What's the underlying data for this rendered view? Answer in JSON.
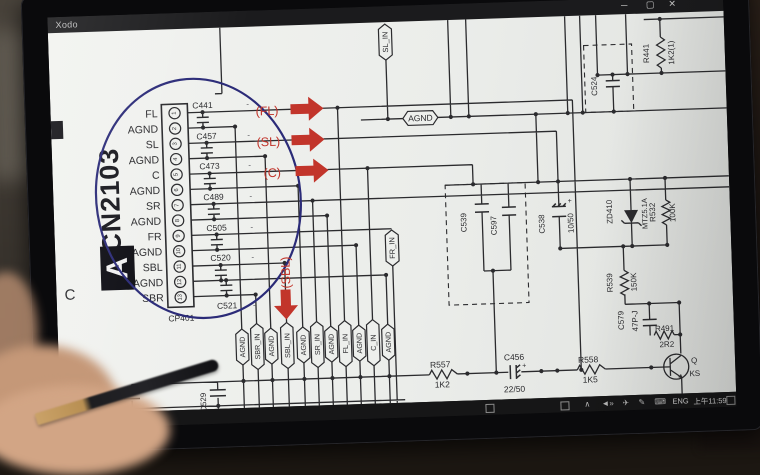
{
  "window": {
    "title": "Xodo",
    "controls": {
      "minimize": "─",
      "maximize": "▢",
      "close": "✕"
    }
  },
  "taskbar": {
    "lang": "ENG",
    "time": "上午11:59"
  },
  "schematic": {
    "grid_letter": "C",
    "dash": "-",
    "connector": {
      "designator_large": "CN2103",
      "marker": "A",
      "footprint": "CP401",
      "pins": [
        {
          "num": "1",
          "name": "FL"
        },
        {
          "num": "2",
          "name": "AGND"
        },
        {
          "num": "3",
          "name": "SL"
        },
        {
          "num": "4",
          "name": "AGND"
        },
        {
          "num": "5",
          "name": "C"
        },
        {
          "num": "6",
          "name": "AGND"
        },
        {
          "num": "7",
          "name": "SR"
        },
        {
          "num": "8",
          "name": "AGND"
        },
        {
          "num": "9",
          "name": "FR"
        },
        {
          "num": "10",
          "name": "AGND"
        },
        {
          "num": "11",
          "name": "SBL"
        },
        {
          "num": "12",
          "name": "AGND"
        },
        {
          "num": "13",
          "name": "SBR"
        }
      ]
    },
    "inline_caps": [
      "C441",
      "C457",
      "C473",
      "C489",
      "C505",
      "C520",
      "C521"
    ],
    "red_arrows": {
      "fl": "(FL)",
      "sl": "(SL)",
      "c": "(C)",
      "sbl": "(SBL)"
    },
    "top_tags": {
      "sl_in": "SL_IN",
      "agnd": "AGND"
    },
    "mid_tag": "FR_IN",
    "bottom_tags": [
      "AGND",
      "SBR_IN",
      "AGND",
      "SBL_IN",
      "AGND",
      "SR_IN",
      "AGND",
      "FL_IN",
      "AGND",
      "C_IN",
      "AGND"
    ],
    "components": {
      "r441": {
        "ref": "R441",
        "value": "1K2(1)"
      },
      "c524": {
        "ref": "C524"
      },
      "c539": {
        "ref": "C539"
      },
      "c597": {
        "ref": "C597"
      },
      "c538": {
        "ref": "C538",
        "value": "10/50"
      },
      "zd410": {
        "ref": "ZD410",
        "part": "MTZ5.1A"
      },
      "r532": {
        "ref": "R532",
        "value": "100K"
      },
      "r539": {
        "ref": "R539",
        "value": "150K"
      },
      "c579": {
        "ref": "C579",
        "value": "47P-J"
      },
      "r491": {
        "ref": "R491",
        "value": "2R2"
      },
      "q": {
        "ref": "Q",
        "part": "KS"
      },
      "r557": {
        "ref": "R557",
        "value": "1K2"
      },
      "c456": {
        "ref": "C456",
        "value": "22/50"
      },
      "r558": {
        "ref": "R558",
        "value": "1K5"
      },
      "c528": {
        "ref": "C528"
      },
      "c529": {
        "ref": "C529"
      }
    }
  },
  "colors": {
    "arrow_red": "#c2352b",
    "annotation_blue": "#2b2b78",
    "ink": "#2b2b2e",
    "page": "#edefec"
  }
}
